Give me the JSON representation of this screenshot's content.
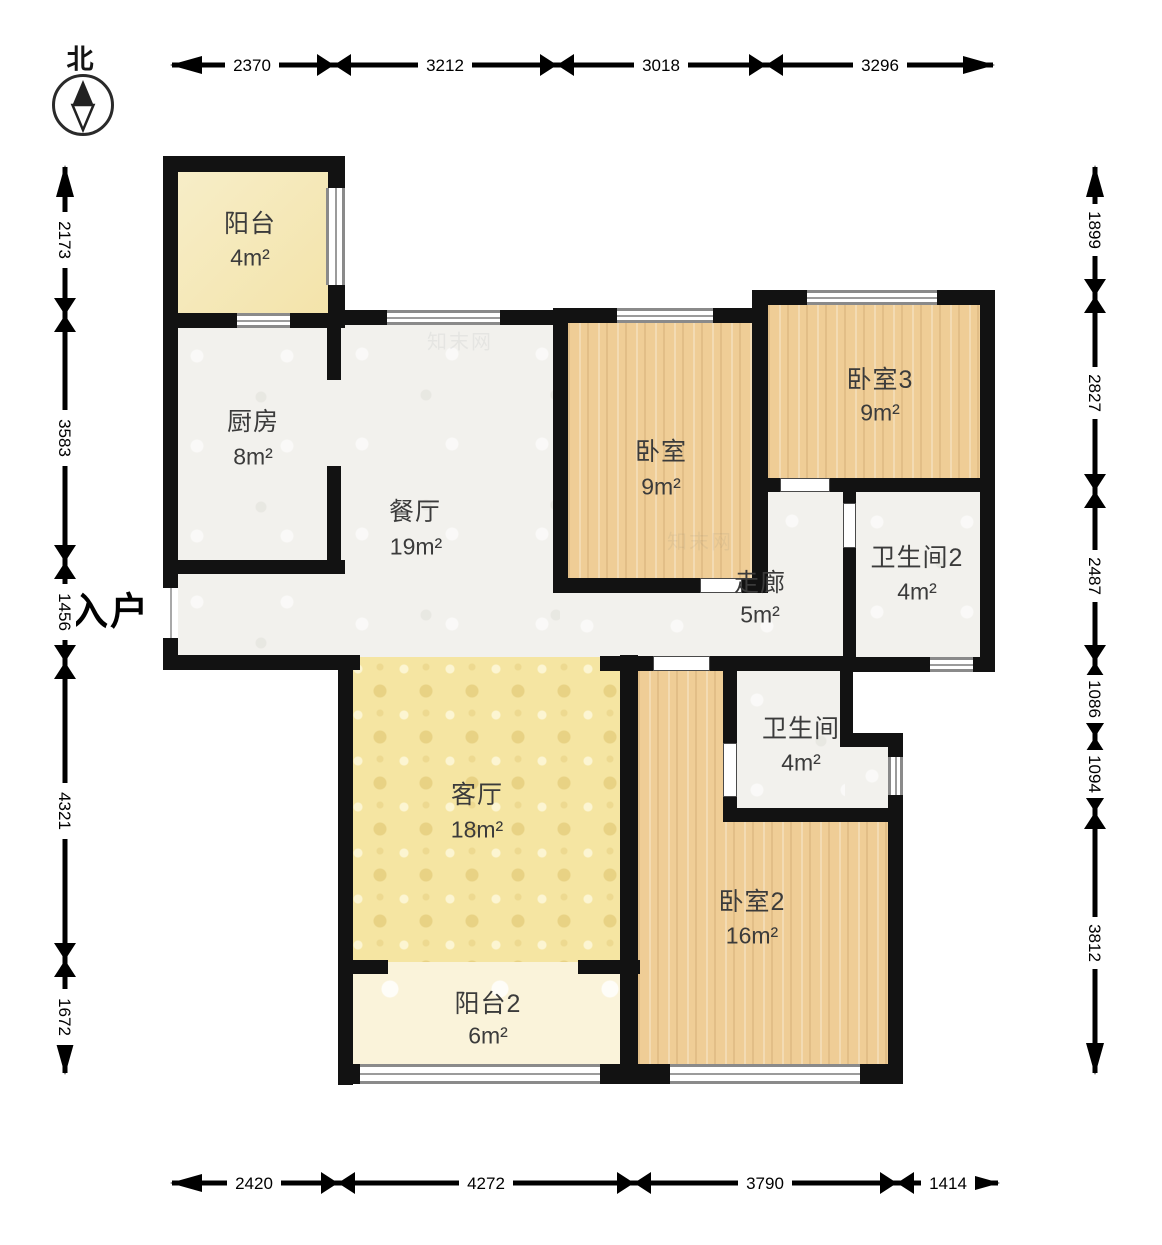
{
  "compass": {
    "north_label": "北"
  },
  "entrance": {
    "label": "入户"
  },
  "watermark": {
    "text": "知末网"
  },
  "rooms": [
    {
      "id": "balcony1",
      "name": "阳台",
      "area": "4m²"
    },
    {
      "id": "kitchen",
      "name": "厨房",
      "area": "8m²"
    },
    {
      "id": "dining",
      "name": "餐厅",
      "area": "19m²"
    },
    {
      "id": "bedroom",
      "name": "卧室",
      "area": "9m²"
    },
    {
      "id": "bedroom3",
      "name": "卧室3",
      "area": "9m²"
    },
    {
      "id": "bath2",
      "name": "卫生间2",
      "area": "4m²"
    },
    {
      "id": "corridor",
      "name": "走廊",
      "area": "5m²"
    },
    {
      "id": "bath",
      "name": "卫生间",
      "area": "4m²"
    },
    {
      "id": "living",
      "name": "客厅",
      "area": "18m²"
    },
    {
      "id": "balcony2",
      "name": "阳台2",
      "area": "6m²"
    },
    {
      "id": "bedroom2",
      "name": "卧室2",
      "area": "16m²"
    }
  ],
  "dimensions": {
    "top": [
      "2370",
      "3212",
      "3018",
      "3296"
    ],
    "bottom": [
      "2420",
      "4272",
      "3790",
      "1414"
    ],
    "left": [
      "2173",
      "3583",
      "1456",
      "4321",
      "1672"
    ],
    "right": [
      "1899",
      "2827",
      "2487",
      "1086",
      "1094",
      "3812"
    ]
  },
  "colors": {
    "wall": "#121212",
    "room_gray": "#f2f1ed",
    "wood": "#efcd96",
    "living_yellow": "#f5e5a2",
    "balcony_cream": "#f4e6b4",
    "balcony2_cream": "#faf3da",
    "dimension_ink": "#000000"
  }
}
